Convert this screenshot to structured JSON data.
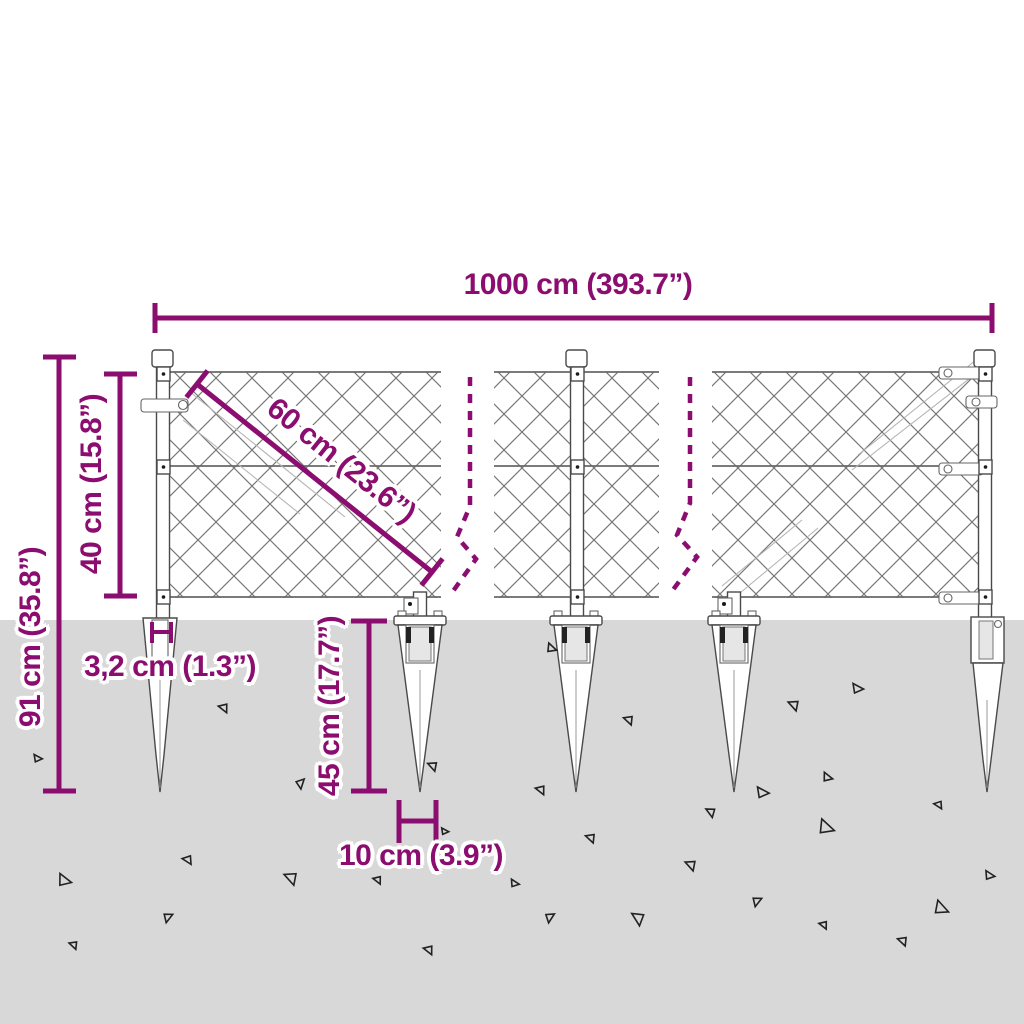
{
  "diagram": {
    "type": "product-dimension-drawing",
    "subject": "chain-link fence panels with ground anchor spikes",
    "colors": {
      "accent": "#8B0D6F",
      "ground": "#D8D8D8",
      "linework": "#4a4a4a"
    },
    "dimensions": {
      "total_width": "1000 cm (393.7”)",
      "total_height": "91 cm (35.8”)",
      "mesh_height": "40 cm (15.8”)",
      "mesh_diagonal": "60 cm (23.6”)",
      "post_width": "3,2 cm (1.3”)",
      "anchor_spike_length": "45 cm (17.7”)",
      "anchor_spike_width": "10 cm (3.9”)"
    }
  }
}
